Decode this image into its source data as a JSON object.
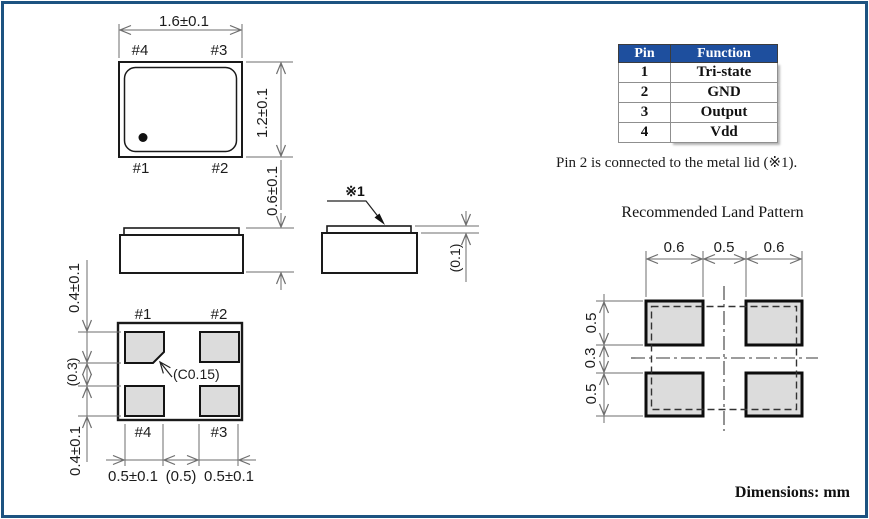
{
  "colors": {
    "frame_border": "#1d5381",
    "table_header_bg": "#1e4f9e",
    "pad_fill": "#dcdcdc"
  },
  "top_view": {
    "width_dim": "1.6±0.1",
    "height_dim": "1.2±0.1",
    "pin_top_left": "#4",
    "pin_top_right": "#3",
    "pin_bottom_left": "#1",
    "pin_bottom_right": "#2"
  },
  "side_view": {
    "height_dim": "0.6±0.1"
  },
  "lid_view": {
    "ref_label": "※1",
    "thickness_dim": "(0.1)"
  },
  "bottom_view": {
    "pin_top_left": "#1",
    "pin_top_right": "#2",
    "pin_bottom_left": "#4",
    "pin_bottom_right": "#3",
    "chamfer_label": "(C0.15)",
    "dim_left_top": "0.4±0.1",
    "dim_left_mid": "(0.3)",
    "dim_left_bottom": "0.4±0.1",
    "dim_bottom_left": "0.5±0.1",
    "dim_bottom_mid": "(0.5)",
    "dim_bottom_right": "0.5±0.1"
  },
  "pin_table": {
    "header_pin": "Pin",
    "header_function": "Function",
    "rows": [
      {
        "pin": "1",
        "function": "Tri-state"
      },
      {
        "pin": "2",
        "function": "GND"
      },
      {
        "pin": "3",
        "function": "Output"
      },
      {
        "pin": "4",
        "function": "Vdd"
      }
    ]
  },
  "note": "Pin 2 is connected to the metal lid (※1).",
  "land_pattern": {
    "title": "Recommended Land Pattern",
    "dim_top_left": "0.6",
    "dim_top_mid": "0.5",
    "dim_top_right": "0.6",
    "dim_left_top": "0.5",
    "dim_left_mid": "0.3",
    "dim_left_bottom": "0.5"
  },
  "footer": "Dimensions: mm"
}
